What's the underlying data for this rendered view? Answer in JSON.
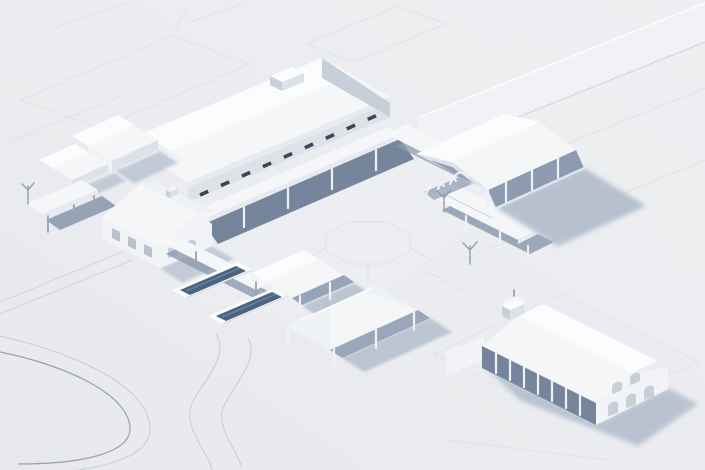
{
  "scene": {
    "type": "3d-architectural-massing-render",
    "view": "axonometric-aerial",
    "style": "white clay model with blue-gray shadows on pale gray site plane",
    "structures": [
      {
        "id": "classroom-building",
        "desc": "long gabled hall with clerestory window strip and roof monitor, upper center"
      },
      {
        "id": "courtyard-walkways",
        "desc": "flat-roofed colonnade canopies on thin posts forming a U around central plaza"
      },
      {
        "id": "central-plaza-octagon",
        "desc": "octagonal path marking in courtyard center"
      },
      {
        "id": "farmhouse",
        "desc": "cross-gabled house with windows, arched entries and chimney, middle left"
      },
      {
        "id": "outbuildings",
        "desc": "two small gabled sheds, upper left"
      },
      {
        "id": "carport-canopy",
        "desc": "mono-pitch canopy on posts, far left"
      },
      {
        "id": "lap-pools",
        "desc": "two dark rectangular pools with white decks, lower left of center"
      },
      {
        "id": "garden-canopy",
        "desc": "small gabled shade canopy next to pools"
      },
      {
        "id": "shade-pavilion-canopy",
        "desc": "hipped canopy on posts, bottom center"
      },
      {
        "id": "east-walkway-canopy",
        "desc": "flat canopy walkway with young trees, center right"
      },
      {
        "id": "arched-trellis",
        "desc": "arched trellis tunnel at courtyard east exit"
      },
      {
        "id": "open-pavilion",
        "desc": "open gable-roof pavilion on posts casting long shadow, center right"
      },
      {
        "id": "chapel",
        "desc": "gabled chapel with arched colonnade and bell cupola, bottom right"
      },
      {
        "id": "service-road-band",
        "desc": "wide diagonal road band, top right"
      },
      {
        "id": "loop-driveway",
        "desc": "curved loop road lines, bottom left"
      },
      {
        "id": "s-curve-road",
        "desc": "S-shaped road lines, bottom center-left"
      },
      {
        "id": "path-markings",
        "desc": "faint rectangular path outlines on ground plane"
      }
    ]
  },
  "colors": {
    "bg": "#e9ebee",
    "bg_grad_hi": "#eef0f2",
    "bg_grad_lo": "#e5e7eb",
    "band": "#f0f2f5",
    "plaza": "#eef0f3",
    "line_faint": "#dfe3e8",
    "line_mid": "#c9ced6",
    "line_dark": "#9aa1ab",
    "roof_bright": "#fbfcfd",
    "roof_lit": "#f4f6f8",
    "roof_mid": "#eff2f5",
    "fascia": "#e7eaef",
    "wall_light": "#f1f3f7",
    "wall_mid": "#dde2e9",
    "wall_shade": "#c7cfd9",
    "shade_deep": "#75859c",
    "shade_canopy": "#8c9bb0",
    "shadow_cast": "#a9b5c6",
    "post_light": "#eef1f5",
    "post_dark": "#9aa4b2",
    "window_dark": "#3c4653",
    "window_light": "#b9c2cd",
    "arch_shade": "#c7cfd9",
    "water": "#4a6480",
    "water_streak": "#7089a5",
    "deck": "#fafbfd"
  }
}
